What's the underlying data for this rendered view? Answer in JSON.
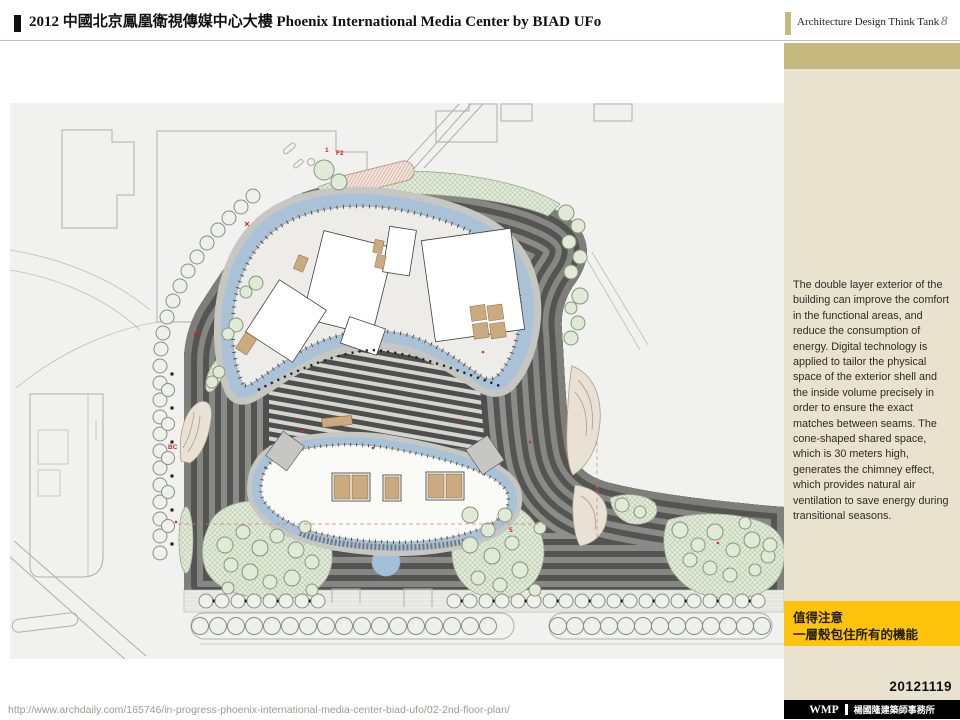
{
  "header": {
    "title": "2012 中國北京鳳凰衛視傳媒中心大樓 Phoenix International Media Center by BIAD UFo",
    "brand": "Architecture Design Think Tank",
    "page_number": "8"
  },
  "sidebar": {
    "paragraph": "The double layer exterior of the building can improve the comfort in the functional areas, and reduce the consumption of energy. Digital technology is applied to tailor the physical space of the exterior shell and the inside volume precisely in order to ensure the exact matches between seams. The cone-shaped shared space, which is 30 meters high, generates the chimney effect, which provides natural air ventilation to save energy during transitional seasons.",
    "highlight": {
      "line1": "值得注意",
      "line2": "一層殼包住所有的機能"
    },
    "date": "20121119"
  },
  "footer": {
    "url": "http://www.archdaily.com/165746/in-progress-phoenix-international-media-center-biad-ufo/02-2nd-floor-plan/",
    "logo": "WMP",
    "firm": "楊國隆建築師事務所"
  },
  "plan": {
    "labels": {
      "road1": "1",
      "road2": "F2",
      "ramp": "BC",
      "gate": "5"
    }
  },
  "colors": {
    "accent_tan": "#c6b97e",
    "sidebar_bg": "#e9e2cf",
    "highlight_yellow": "#fec40c",
    "footer_bar": "#000000",
    "plan_blue": "#a9c2d8",
    "plan_green": "#dfe9d6",
    "plan_dark": "#565654"
  }
}
